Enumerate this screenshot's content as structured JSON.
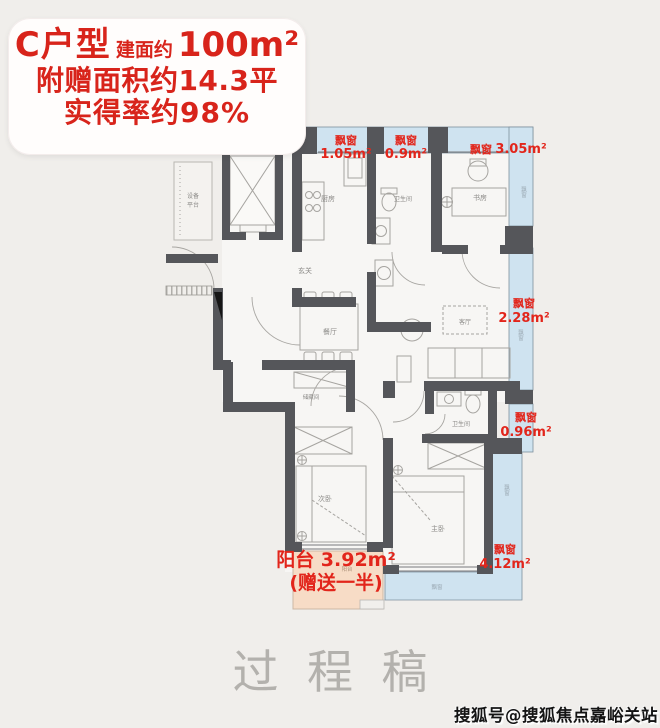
{
  "header": {
    "unit": "C户型",
    "area_prefix": "建面约",
    "area_value": "100m²",
    "bonus": "附赠面积约14.3平",
    "rate": "实得率约98%"
  },
  "rooms": {
    "equipment_1": "设备",
    "equipment_2": "平台",
    "kitchen": "厨房",
    "bath_top": "卫生间",
    "study": "书房",
    "entry": "玄关",
    "dining": "餐厅",
    "living": "客厅",
    "bath_bottom": "卫生间",
    "storage": "储藏间",
    "bedroom_second": "次卧",
    "bedroom_master": "主卧",
    "balcony_tag": "阳台",
    "bay_tag": "飘窗"
  },
  "bays": [
    {
      "name": "飘窗",
      "area": "1.05m²"
    },
    {
      "name": "飘窗",
      "area": "0.9m²"
    },
    {
      "name": "飘窗",
      "area": "3.05m²"
    },
    {
      "name": "飘窗",
      "area": "2.28m²"
    },
    {
      "name": "飘窗",
      "area": "0.96m²"
    },
    {
      "name": "飘窗",
      "area": "4.12m²"
    }
  ],
  "balcony": {
    "title": "阳台 3.92m²",
    "note": "(赠送一半)"
  },
  "watermark": "过程稿",
  "credit": "搜狐号@搜狐焦点嘉峪关站",
  "colors": {
    "accent_red": "#e2251b",
    "bay_blue": "#cfe3f0",
    "balcony_peach": "#f7dcc6",
    "wall_gray": "#55565a",
    "background": "#f0eeeb"
  }
}
